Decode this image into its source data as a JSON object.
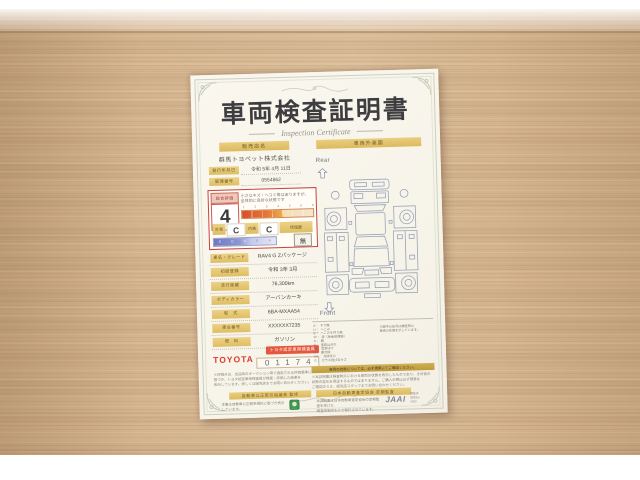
{
  "doc": {
    "title": "車両検査証明書",
    "subtitle": "Inspection Certificate",
    "dealer": {
      "header": "販売店名",
      "name": "群馬トヨペット株式会社",
      "issue_label": "発行年月日",
      "issue_value": "令和 5年 4月 11日",
      "number_label": "管理番号",
      "number_value": "0554862"
    },
    "evaluation": {
      "header": "総合評価",
      "score": "4",
      "note_line1": "小さなキズ・ヘコミ等はありますが、",
      "note_line2": "全体的に良好な状態です",
      "scale_ticks": [
        "1",
        "2",
        "3",
        "4",
        "5",
        "6",
        "S"
      ],
      "exterior_label": "外装",
      "exterior_grade": "C",
      "interior_label": "内装",
      "interior_grade": "C",
      "grade_ticks": [
        "E",
        "D",
        "C",
        "B",
        "A"
      ],
      "repair_label": "修復歴",
      "repair_value": "無"
    },
    "details": [
      {
        "label": "車名・グレード",
        "value": "RAV4 G Zパッケージ"
      },
      {
        "label": "初度登録",
        "value": "令和 3年 3月"
      },
      {
        "label": "走行距離",
        "value": "76,300km"
      },
      {
        "label": "ボディカラー",
        "value": "アーバンカーキ"
      },
      {
        "label": "型　式",
        "value": "6BA-MXAA54"
      },
      {
        "label": "車台番号",
        "value": "XXXXXX7235"
      },
      {
        "label": "燃　料",
        "value": "ガソリン"
      }
    ],
    "inspector": {
      "badge": "トヨタ認定車両検査員",
      "brand": "TOYOTA",
      "number": "01174",
      "fineprint_1": "※評価点は、出品時のオークション等で適用される評価基準に",
      "fineprint_2": "基づき、トヨタ認定車両検査員が検査・評価した結果を",
      "fineprint_3": "表示しています。詳しくは販売店までお問い合わせください。"
    },
    "diagram": {
      "header": "車両外装図",
      "rear_label": "Rear",
      "front_label": "Front",
      "legend": [
        "A ： すり傷",
        "U ： へこみ",
        "B ： へこみを伴う傷",
        "W ： 波（板金修理跡）",
        "S ： 錆",
        "P ： 塗装はがれ",
        "H ： 塗装はげ",
        "X ： 要交換",
        "XX ： 交換済み",
        "G ： ガラス飛び石キズ"
      ],
      "legend_note_1": "※図中の記号は検査時の",
      "legend_note_2": "車両の状態を示しています。",
      "notice": "車両の状態については、必ず現車にてご確認ください。",
      "fineprint_1": "※本証明書は検査時点における車両の状態を表示したものであり、その後の",
      "fineprint_2": "状態の変化を保証するものではありません。ご購入の際は必ず現車を",
      "fineprint_3": "ご確認のうえ、販売店スタッフまでお問い合わせください。"
    },
    "footer": {
      "left_bar": "自動車公正取引協議会 監修",
      "right_bar": "日本自動車査定協会 定期監査",
      "left_note": "本書は自動車公正競争規約に基づき表示しています。",
      "right_note_1": "本証明書は日本自動車査定協会の定期監査を受けた",
      "right_note_2": "検査体制のもとで発行されています。",
      "jaai": "JAAI",
      "stamp_1": "検査済",
      "stamp_2": "認定No.",
      "stamp_3": "0000"
    }
  }
}
